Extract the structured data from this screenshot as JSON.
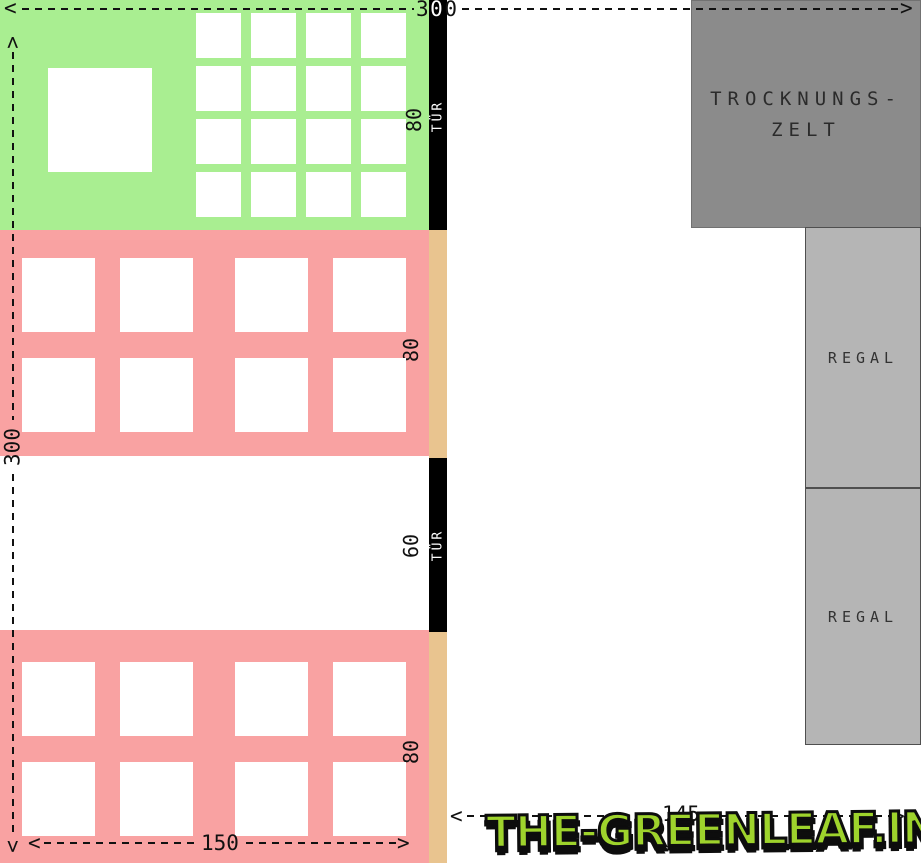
{
  "plan": {
    "dim_top": "300",
    "dim_left": "300",
    "dim_bottom": "150",
    "dim_right": "145",
    "door_top": {
      "label": "TÜR",
      "width": "80"
    },
    "door_mid": {
      "label": "TÜR",
      "width": "60"
    },
    "bed1_width": "80",
    "bed2_width": "80",
    "drying_tent": {
      "line1": "TROCKNUNGS-",
      "line2": "ZELT"
    },
    "shelf1": "REGAL",
    "shelf2": "REGAL"
  },
  "grids": {
    "green_table": {
      "rows": 4,
      "cols": 4
    },
    "bed1": {
      "rows": 2,
      "cols": 4
    },
    "bed2": {
      "rows": 2,
      "cols": 4
    }
  },
  "icons": {
    "arrow_left": "<",
    "arrow_right": ">",
    "arrow_up": "<",
    "arrow_down": ">"
  },
  "colors": {
    "green_room": "#a9ee91",
    "pink_bed": "#f9a2a2",
    "tan_wall": "#e9c48f",
    "door": "#000000",
    "drying_tent": "#8b8b8b",
    "shelf": "#b5b5b5",
    "line": "#111111",
    "watermark_green": "#9ed32c",
    "watermark_outline": "#0d0d0d"
  },
  "watermark": "THE-GREENLEAF.IN"
}
